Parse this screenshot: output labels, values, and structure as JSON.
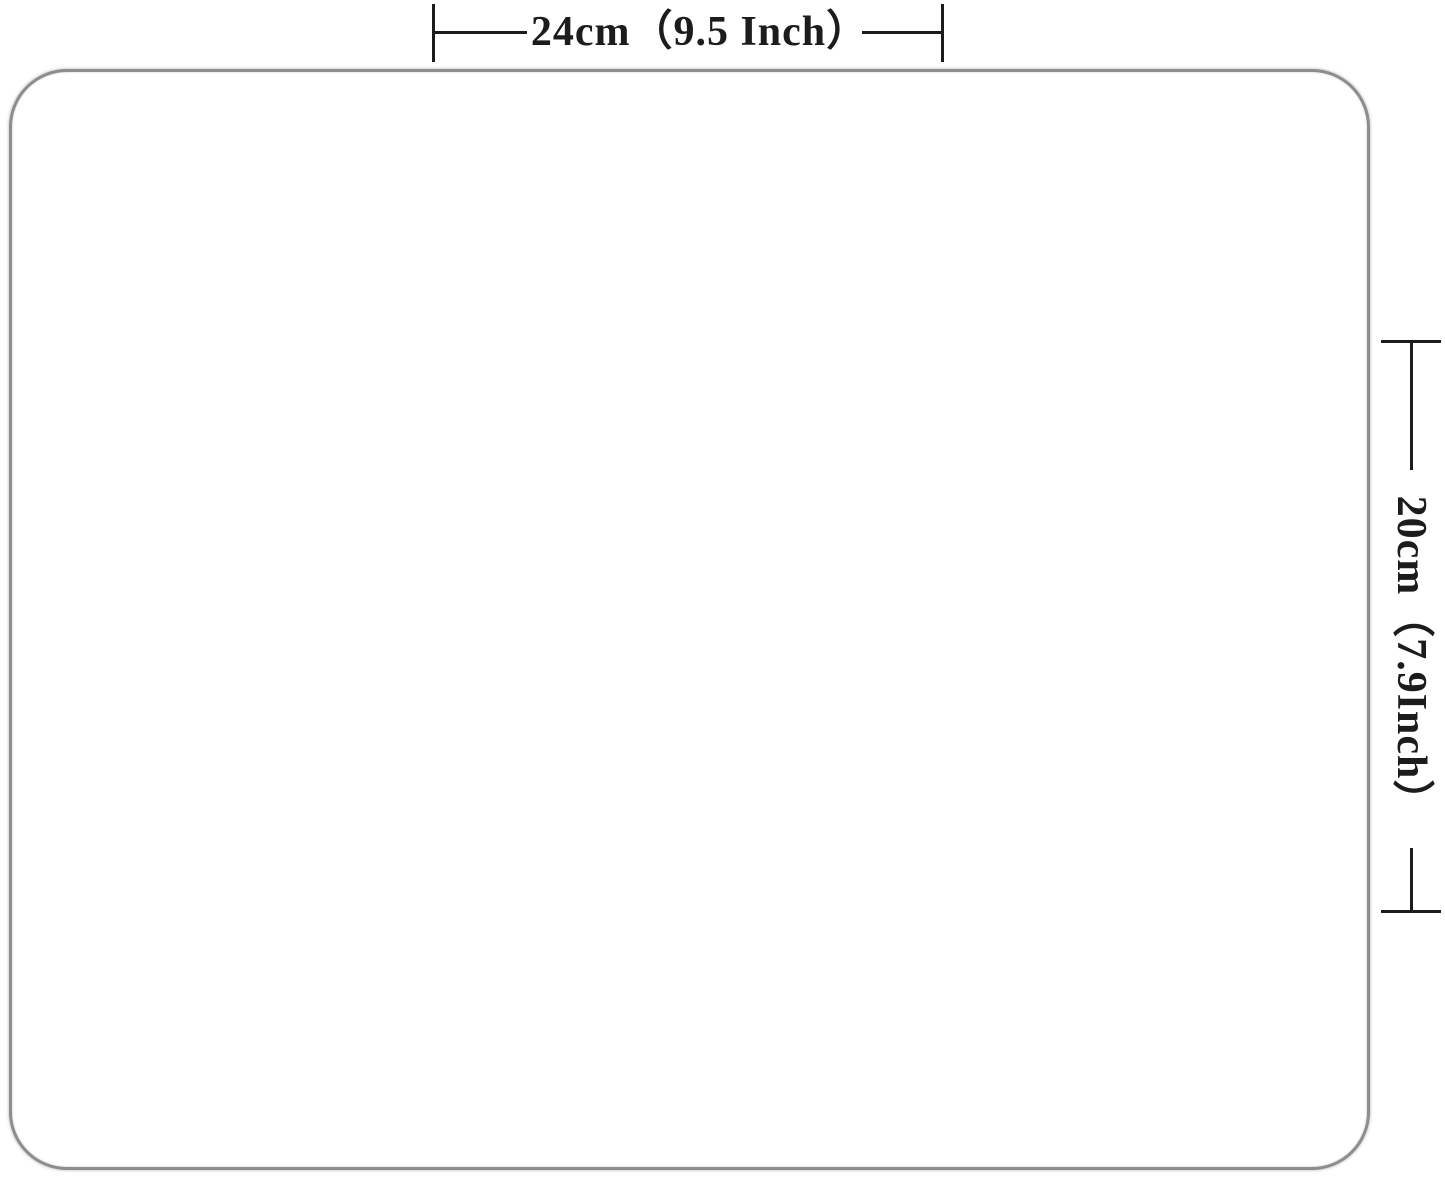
{
  "diagram": {
    "description": "mousepad size specification diagram",
    "width_dimension": {
      "label": "24cm（9.5 Inch）"
    },
    "height_dimension": {
      "label": "20cm（7.9Inch）"
    },
    "colors": {
      "dimension_line": "#1c1c1c",
      "pad_border": "#8d8d8d",
      "background": "#ffffff"
    }
  }
}
